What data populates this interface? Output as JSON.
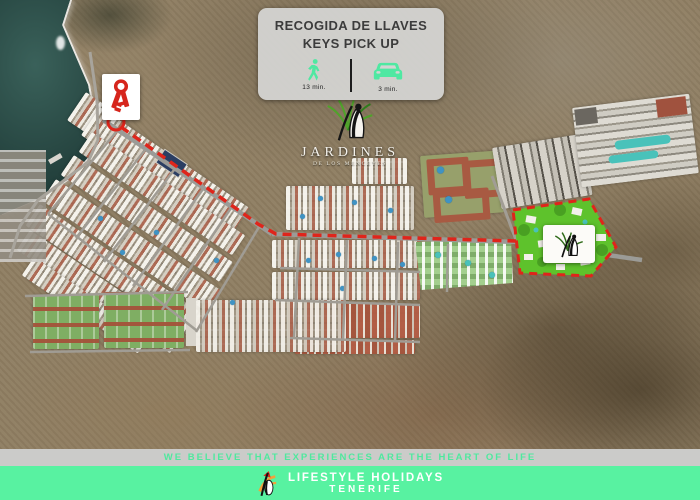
{
  "sign": {
    "title_line1": "RECOGIDA DE LLAVES",
    "title_line2": "KEYS PICK UP",
    "walk_time": "13 min.",
    "drive_time": "3 min.",
    "icons": {
      "walk": "walking-person-icon",
      "drive": "car-icon"
    }
  },
  "map": {
    "resort_logo": {
      "name": "JARDINES",
      "subtitle": "DE LOS MENCEYES"
    },
    "markers": {
      "pickup_icon": "red-keys-icon",
      "pickup_circle": "red-circle-highlight",
      "route_style": "red-dashed-line",
      "destination_highlight": "green-resort-area"
    }
  },
  "footer": {
    "tagline": "WE BELIEVE THAT EXPERIENCES ARE THE HEART OF LIFE",
    "brand_line1": "LIFESTYLE HOLIDAYS",
    "brand_line2": "TENERIFE"
  },
  "colors": {
    "mint_accent": "#58F2A1",
    "route_red": "#DF251B",
    "highlight_green": "#5EC22C",
    "ocean": "#223F3B",
    "sign_bg": "#D4D4D2"
  }
}
